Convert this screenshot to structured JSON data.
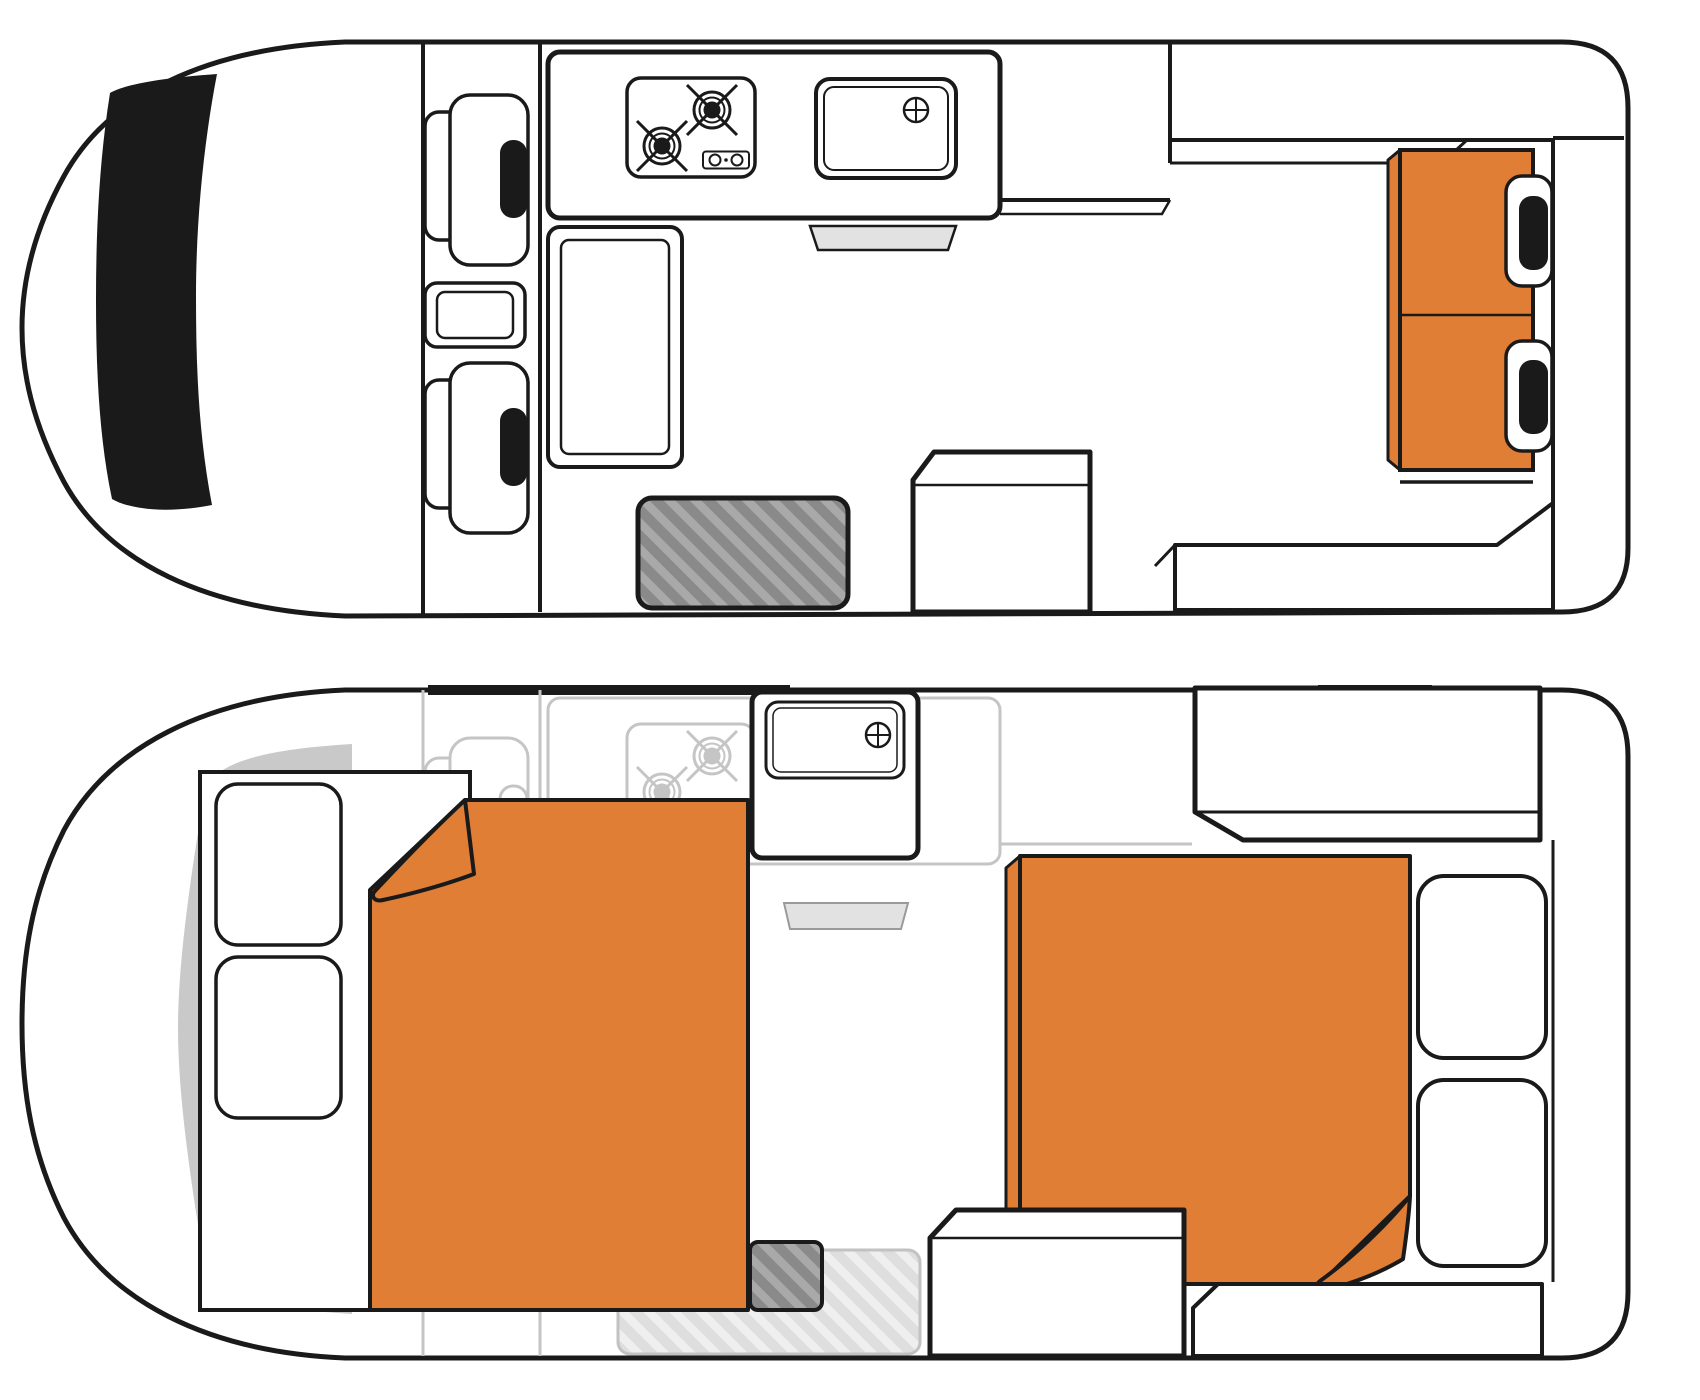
{
  "page": {
    "title": "Campervan floorplan — day and night layouts",
    "background": "#FFFFFF"
  },
  "colors": {
    "accent": "#E17E35",
    "ink": "#1A1A1A",
    "curtain": "#C9C9C9",
    "tray": "#E2E2E2",
    "step_fill": "#A9A9A9",
    "step_stripe": "#8A8A8A",
    "faded_step_fill": "#EFEFEF",
    "faded_step_stripe": "#DEDEDE",
    "faded_line": "#C5C5C5"
  },
  "floorplans": [
    {
      "id": "day",
      "label": "Day layout",
      "features": [
        "cab windshield",
        "driver seat",
        "passenger seat",
        "center console",
        "two-burner stove",
        "sink with drain",
        "cutlery tray",
        "wardrobe cabinet",
        "kitchen counter",
        "overhead cabinet",
        "dinette table",
        "rear bench seat with two headrests",
        "rear storage bench",
        "entry step"
      ]
    },
    {
      "id": "night",
      "label": "Night layout",
      "features": [
        "privacy curtain",
        "bed base panel",
        "two pillows",
        "front double bed with folded duvet corner",
        "faded cab seats",
        "faded stove",
        "sink with drain",
        "cutlery tray",
        "rear overhead cabinet",
        "rear double bed with folded duvet corner",
        "rear seat cushions",
        "storage box",
        "rear storage bench",
        "entry step"
      ]
    }
  ]
}
